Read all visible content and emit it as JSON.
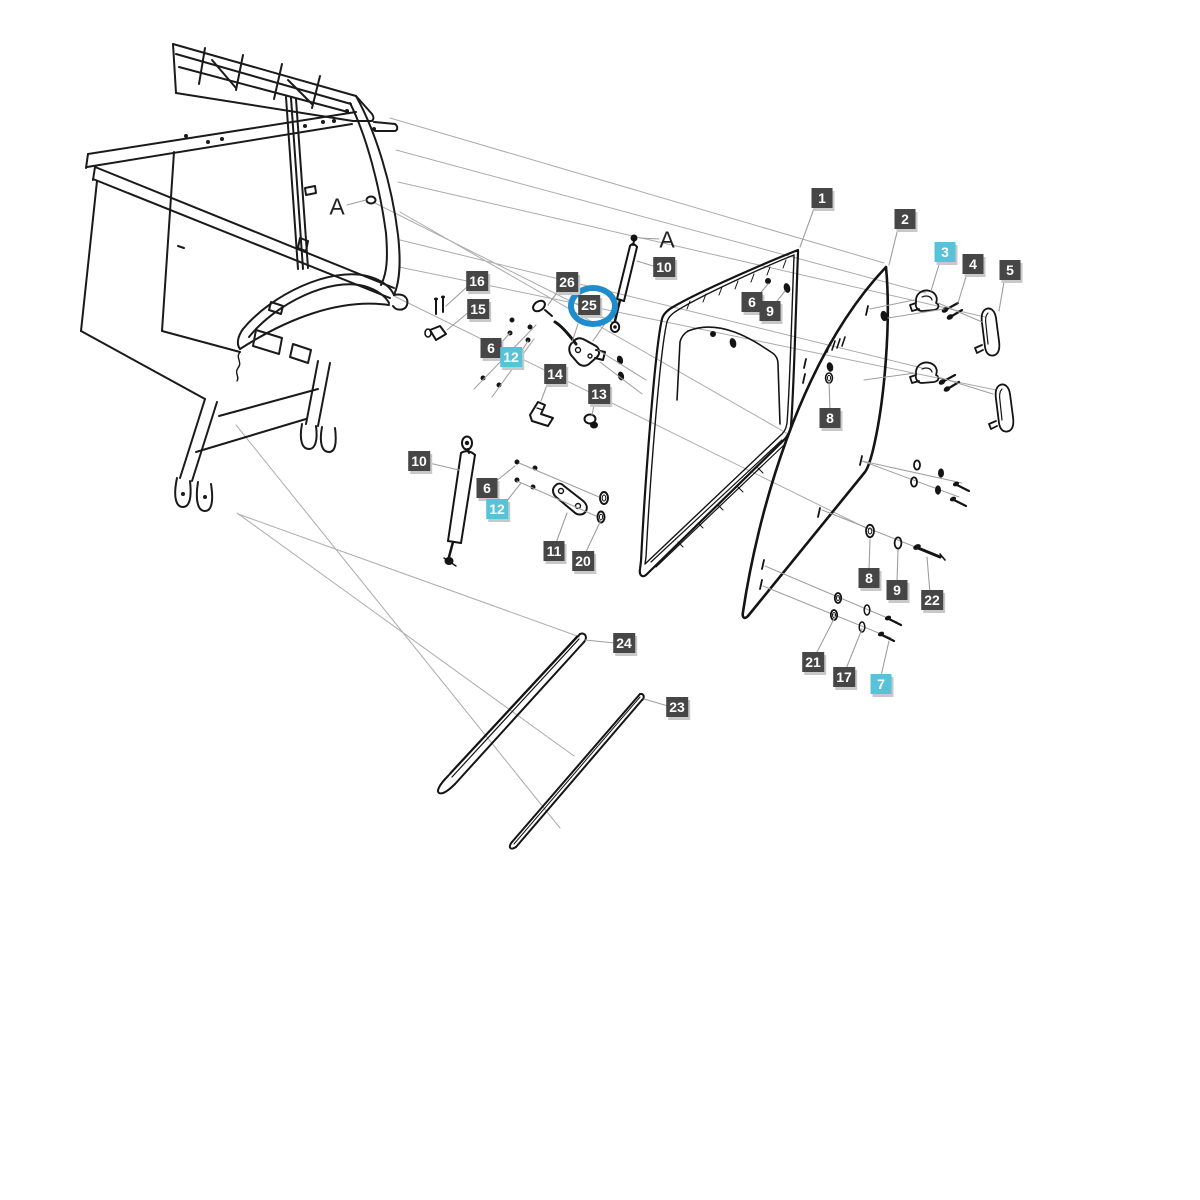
{
  "diagram": {
    "type": "exploded-parts-diagram",
    "subject": "tractor cab door assembly exploded view",
    "colors": {
      "background": "#ffffff",
      "label_dark_bg": "#464646",
      "label_cyan_bg": "#58c2d9",
      "label_text": "#ffffff",
      "label_shadow": "#c8c8c8",
      "selection_ring": "#1e8ccd",
      "line_dark": "#1a1a1a",
      "line_gray": "#9e9e9e"
    },
    "selected_part": "25",
    "part_labels": [
      {
        "name": "part-label-1",
        "text": "1",
        "x": 822,
        "y": 198,
        "style": "dark"
      },
      {
        "name": "part-label-2",
        "text": "2",
        "x": 905,
        "y": 219,
        "style": "dark"
      },
      {
        "name": "part-label-3",
        "text": "3",
        "x": 945,
        "y": 252,
        "style": "cyan"
      },
      {
        "name": "part-label-4",
        "text": "4",
        "x": 973,
        "y": 264,
        "style": "dark"
      },
      {
        "name": "part-label-5",
        "text": "5",
        "x": 1010,
        "y": 270,
        "style": "dark"
      },
      {
        "name": "part-label-10a",
        "text": "10",
        "x": 664,
        "y": 267,
        "style": "dark"
      },
      {
        "name": "part-label-26",
        "text": "26",
        "x": 567,
        "y": 282,
        "style": "dark"
      },
      {
        "name": "part-label-25",
        "text": "25",
        "x": 589,
        "y": 305,
        "style": "dark",
        "circled": true
      },
      {
        "name": "part-label-16",
        "text": "16",
        "x": 477,
        "y": 281,
        "style": "dark"
      },
      {
        "name": "part-label-15",
        "text": "15",
        "x": 478,
        "y": 309,
        "style": "dark"
      },
      {
        "name": "part-label-6a",
        "text": "6",
        "x": 752,
        "y": 302,
        "style": "dark"
      },
      {
        "name": "part-label-9a",
        "text": "9",
        "x": 770,
        "y": 311,
        "style": "dark"
      },
      {
        "name": "part-label-6b",
        "text": "6",
        "x": 491,
        "y": 348,
        "style": "dark"
      },
      {
        "name": "part-label-12a",
        "text": "12",
        "x": 511,
        "y": 357,
        "style": "cyan"
      },
      {
        "name": "part-label-14",
        "text": "14",
        "x": 555,
        "y": 374,
        "style": "dark"
      },
      {
        "name": "part-label-13",
        "text": "13",
        "x": 599,
        "y": 394,
        "style": "dark"
      },
      {
        "name": "part-label-8a",
        "text": "8",
        "x": 830,
        "y": 418,
        "style": "dark"
      },
      {
        "name": "part-label-10b",
        "text": "10",
        "x": 419,
        "y": 461,
        "style": "dark"
      },
      {
        "name": "part-label-6c",
        "text": "6",
        "x": 487,
        "y": 488,
        "style": "dark"
      },
      {
        "name": "part-label-12b",
        "text": "12",
        "x": 497,
        "y": 509,
        "style": "cyan"
      },
      {
        "name": "part-label-11",
        "text": "11",
        "x": 554,
        "y": 551,
        "style": "dark"
      },
      {
        "name": "part-label-20",
        "text": "20",
        "x": 583,
        "y": 561,
        "style": "dark"
      },
      {
        "name": "part-label-8b",
        "text": "8",
        "x": 869,
        "y": 578,
        "style": "dark"
      },
      {
        "name": "part-label-9b",
        "text": "9",
        "x": 897,
        "y": 590,
        "style": "dark"
      },
      {
        "name": "part-label-22",
        "text": "22",
        "x": 932,
        "y": 600,
        "style": "dark"
      },
      {
        "name": "part-label-21",
        "text": "21",
        "x": 813,
        "y": 662,
        "style": "dark"
      },
      {
        "name": "part-label-17",
        "text": "17",
        "x": 844,
        "y": 677,
        "style": "dark"
      },
      {
        "name": "part-label-7",
        "text": "7",
        "x": 881,
        "y": 684,
        "style": "cyan"
      },
      {
        "name": "part-label-24",
        "text": "24",
        "x": 624,
        "y": 643,
        "style": "dark"
      },
      {
        "name": "part-label-23",
        "text": "23",
        "x": 677,
        "y": 707,
        "style": "dark"
      }
    ],
    "reference_markers": [
      {
        "name": "marker-a-pillar",
        "text": "A",
        "x": 337,
        "y": 207
      },
      {
        "name": "marker-a-strut",
        "text": "A",
        "x": 667,
        "y": 240
      }
    ],
    "selection_ring": {
      "x": 593,
      "y": 306,
      "width": 50,
      "height": 42
    }
  }
}
